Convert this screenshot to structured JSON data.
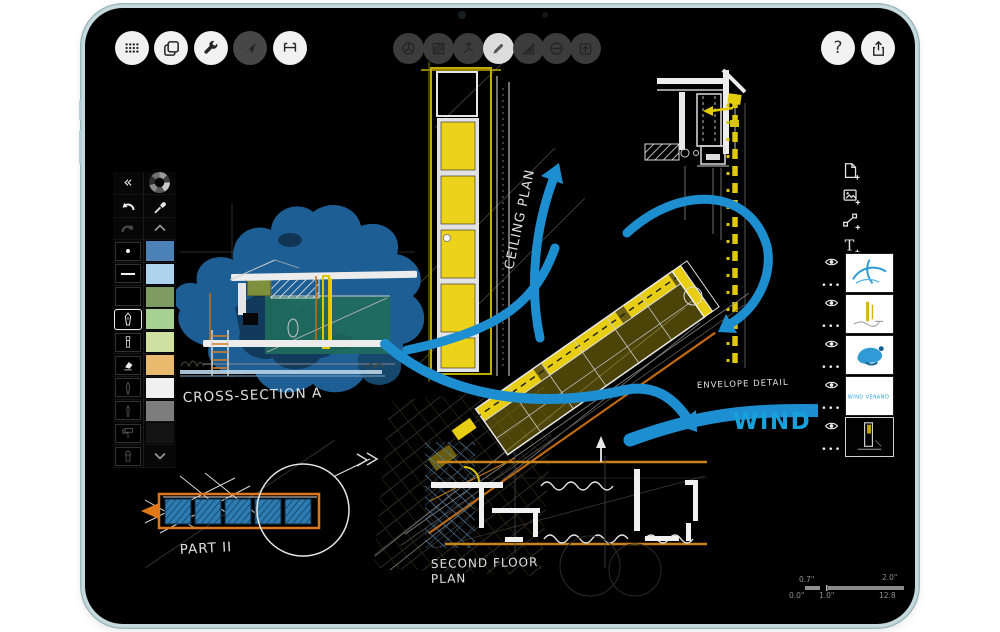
{
  "device": {
    "type": "ipad",
    "camera": "front-camera"
  },
  "toolbar_left": {
    "icons": [
      "grid-dots-icon",
      "pages-icon",
      "wrench-icon",
      "cursor-arrow-icon",
      "measure-icon"
    ],
    "active_index": 3
  },
  "toolbar_center": {
    "icons": [
      "sphere-3d-icon",
      "hatch-fill-icon",
      "axis-compass-icon",
      "pen-icon",
      "set-square-icon",
      "circle-minus-icon",
      "box-arrow-up-icon"
    ],
    "active_index": 3
  },
  "toolbar_right": {
    "help_label": "?",
    "icons": [
      "question-icon",
      "share-icon"
    ]
  },
  "tools_panel": {
    "collapse_glyph": "«",
    "tool_slots": [
      "stroke-dot",
      "stroke-line",
      "empty",
      "pen",
      "marker",
      "eraser",
      "pencil",
      "fineliner",
      "roller",
      "airbrush"
    ],
    "selected_tool": "pen",
    "options_glyph": "•••",
    "swatches": [
      "#4d82b8",
      "#aed3ec",
      "#7e9b61",
      "#a7d093",
      "#cfe0a0",
      "#e9b96e",
      "#f0f0f0",
      "#7d7d7d",
      "#141414"
    ]
  },
  "layers_panel": {
    "add_icons": [
      "add-page-icon",
      "add-image-icon",
      "add-nodes-icon",
      "add-text-icon"
    ],
    "add_text_glyph": "T",
    "layers": [
      {
        "id": "arrows-sketch"
      },
      {
        "id": "yellow-annotations"
      },
      {
        "id": "blue-massing"
      },
      {
        "id": "wind-verano-text",
        "thumb_text": "WIND VERANO"
      },
      {
        "id": "base-drawing",
        "selected": true
      }
    ]
  },
  "canvas": {
    "labels": {
      "cross_section": "CROSS-SECTION A",
      "ceiling_plan": "CEILING PLAN",
      "envelope_detail": "ENVELOPE DETAIL",
      "wind_text": "WIND VE",
      "part": "PART II",
      "second_floor_line1": "SECOND FLOOR",
      "second_floor_line2": "PLAN"
    },
    "scale_legend": {
      "top": [
        "0.7\"",
        "2.0\""
      ],
      "bottom": [
        "0.0\"",
        "1.0\"",
        "12.8"
      ]
    },
    "colors": {
      "highlight_yellow": "#e8ce12",
      "arrow_blue": "#1d8fd0",
      "blob_blue": "#1d5f94",
      "section_teal": "#1f6a5e",
      "plan_orange": "#c98418",
      "wind_text_blue": "#18a0da"
    }
  }
}
